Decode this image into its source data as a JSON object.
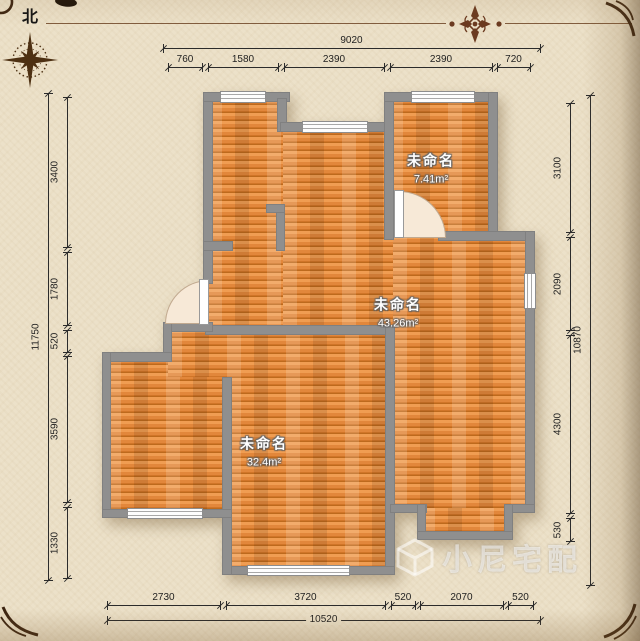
{
  "compass": {
    "north_label": "北"
  },
  "rooms": [
    {
      "name": "未命名",
      "area": "7.41m²"
    },
    {
      "name": "未命名",
      "area": "43.26m²"
    },
    {
      "name": "未命名",
      "area": "32.4m²"
    }
  ],
  "dimensions": {
    "top": {
      "total": "9020",
      "segments": [
        "760",
        "1580",
        "2390",
        "2390",
        "720"
      ]
    },
    "left": {
      "total": "11750",
      "segments": [
        "3400",
        "1780",
        "520",
        "3590",
        "1330"
      ]
    },
    "right": {
      "total": "10870",
      "segments": [
        "3100",
        "2090",
        "4300",
        "530"
      ]
    },
    "bottom": {
      "total": "10520",
      "segments": [
        "2730",
        "3720",
        "520",
        "2070",
        "520"
      ]
    }
  },
  "watermark": {
    "brand": "小尼宅配"
  },
  "colors": {
    "wall": "#8f8f8f",
    "floor": "#e2873b",
    "floor_light": "#f09d52",
    "floor_dark": "#bd6a1d",
    "background": "#ece1c9",
    "dimension_text": "#1f1f1f",
    "ornament": "#6b3a20",
    "compass": "#4d3012"
  }
}
